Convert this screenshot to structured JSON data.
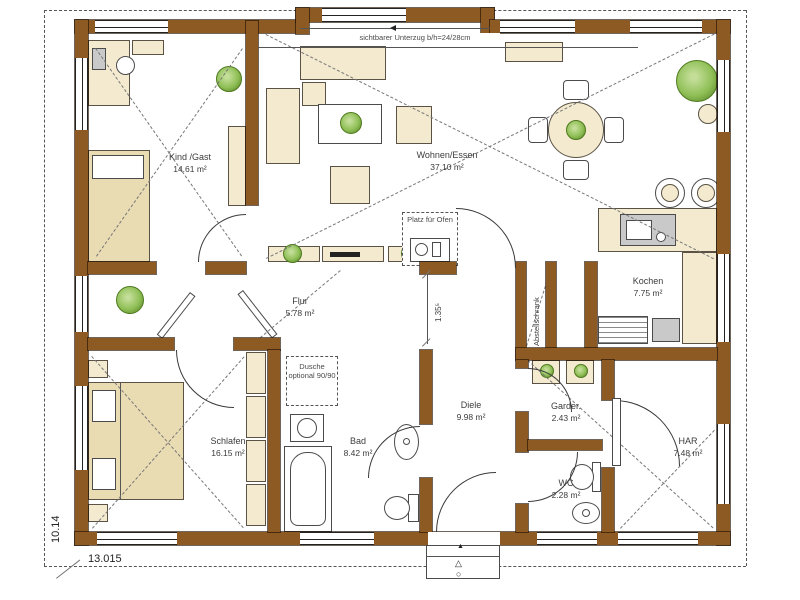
{
  "rooms": [
    {
      "name": "Kind /Gast",
      "area": "14.61 m²"
    },
    {
      "name": "Wohnen/Essen",
      "area": "37.10 m²"
    },
    {
      "name": "Kochen",
      "area": "7.75 m²"
    },
    {
      "name": "Flur",
      "area": "5.78 m²"
    },
    {
      "name": "Abstellschrank",
      "area": ""
    },
    {
      "name": "Schlafen",
      "area": "16.15 m²"
    },
    {
      "name": "Bad",
      "area": "8.42 m²"
    },
    {
      "name": "Diele",
      "area": "9.98 m²"
    },
    {
      "name": "Garder.",
      "area": "2.43 m²"
    },
    {
      "name": "WC",
      "area": "2.28 m²"
    },
    {
      "name": "HAR",
      "area": "7.48 m²"
    }
  ],
  "annotations": {
    "beam": "sichtbarer Unterzug b/h=24/28cm",
    "oven": "Platz für Ofen",
    "shower": "Dusche optional 90/90"
  },
  "dimensions": {
    "total_width": "13.015",
    "total_height": "10.14",
    "flur_opening": "1.35⁵"
  },
  "icons": {
    "entrance_arrow": "▲",
    "entrance_marker_triangle": "△",
    "entrance_marker_circle": "○"
  },
  "colors": {
    "wall": "#8d5a23",
    "furniture": "#f3ead0",
    "furniture_shade": "#e9dbb2",
    "plant": "#8fbf56",
    "plant_dark": "#4f7a1f",
    "fixture": "#c9c9c9",
    "line": "#333333"
  }
}
